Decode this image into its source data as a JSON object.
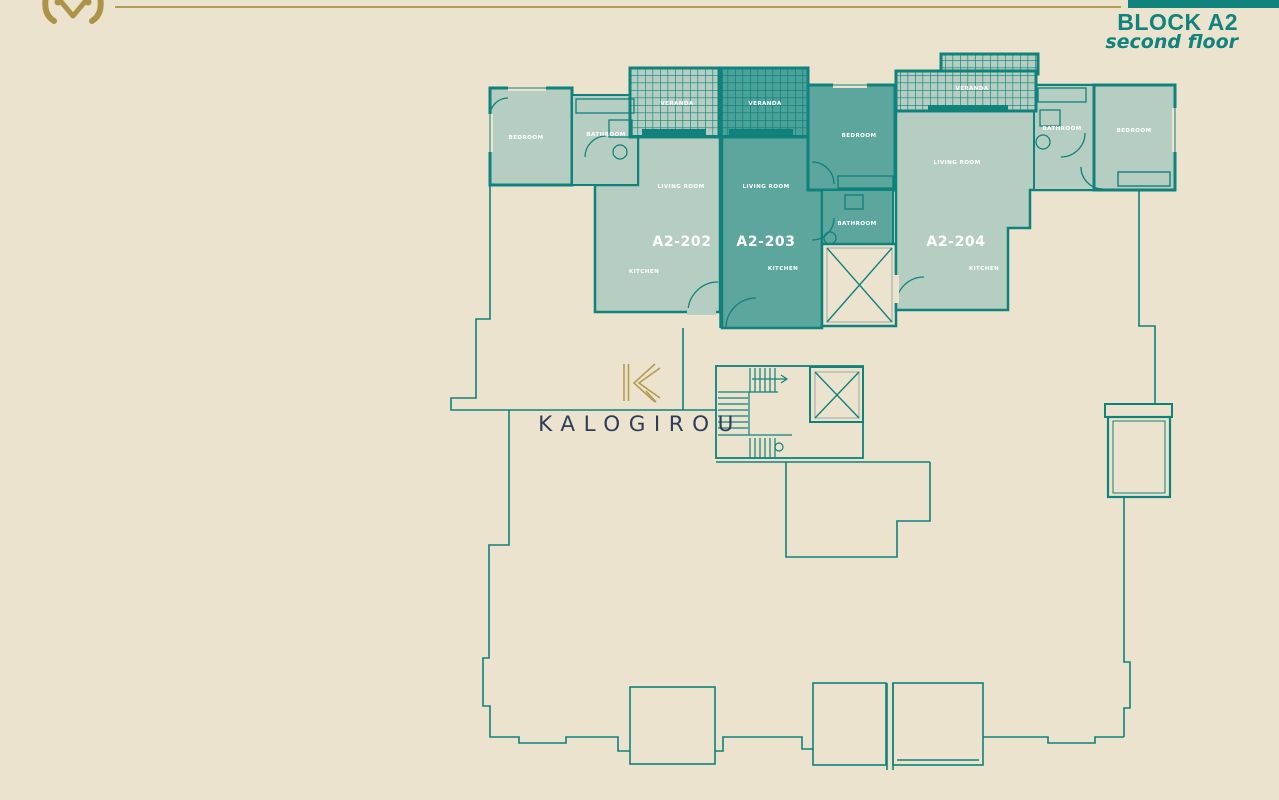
{
  "header": {
    "block": "BLOCK A2",
    "floor": "second floor"
  },
  "brand": {
    "name": "KALOGIROU",
    "monogram": "K"
  },
  "apartments": [
    {
      "id": "A2-202",
      "labels": {
        "bedroom": "BEDROOM",
        "bathroom": "BATHROOM",
        "veranda": "VERANDA",
        "living": "LIVING ROOM",
        "kitchen": "KITCHEN"
      }
    },
    {
      "id": "A2-203",
      "labels": {
        "veranda": "VERANDA",
        "living": "LIVING ROOM",
        "bedroom": "BEDROOM",
        "bathroom": "BATHROOM",
        "kitchen": "KITCHEN"
      }
    },
    {
      "id": "A2-204",
      "labels": {
        "veranda": "VERANDA",
        "living": "LIVING ROOM",
        "bathroom": "BATHROOM",
        "bedroom": "BEDROOM",
        "kitchen": "KITCHEN"
      }
    }
  ],
  "colors": {
    "background": "#ece3cf",
    "wall_teal": "#0e827b",
    "unit_light_fill": "#b6cec1",
    "unit_dark_fill": "#5ca69e",
    "veranda_dark_fill": "#4aa29a",
    "accent_teal": "#0f837c",
    "gold": "#b59a52",
    "navy": "#2e3d58",
    "label_white": "#ffffff"
  }
}
